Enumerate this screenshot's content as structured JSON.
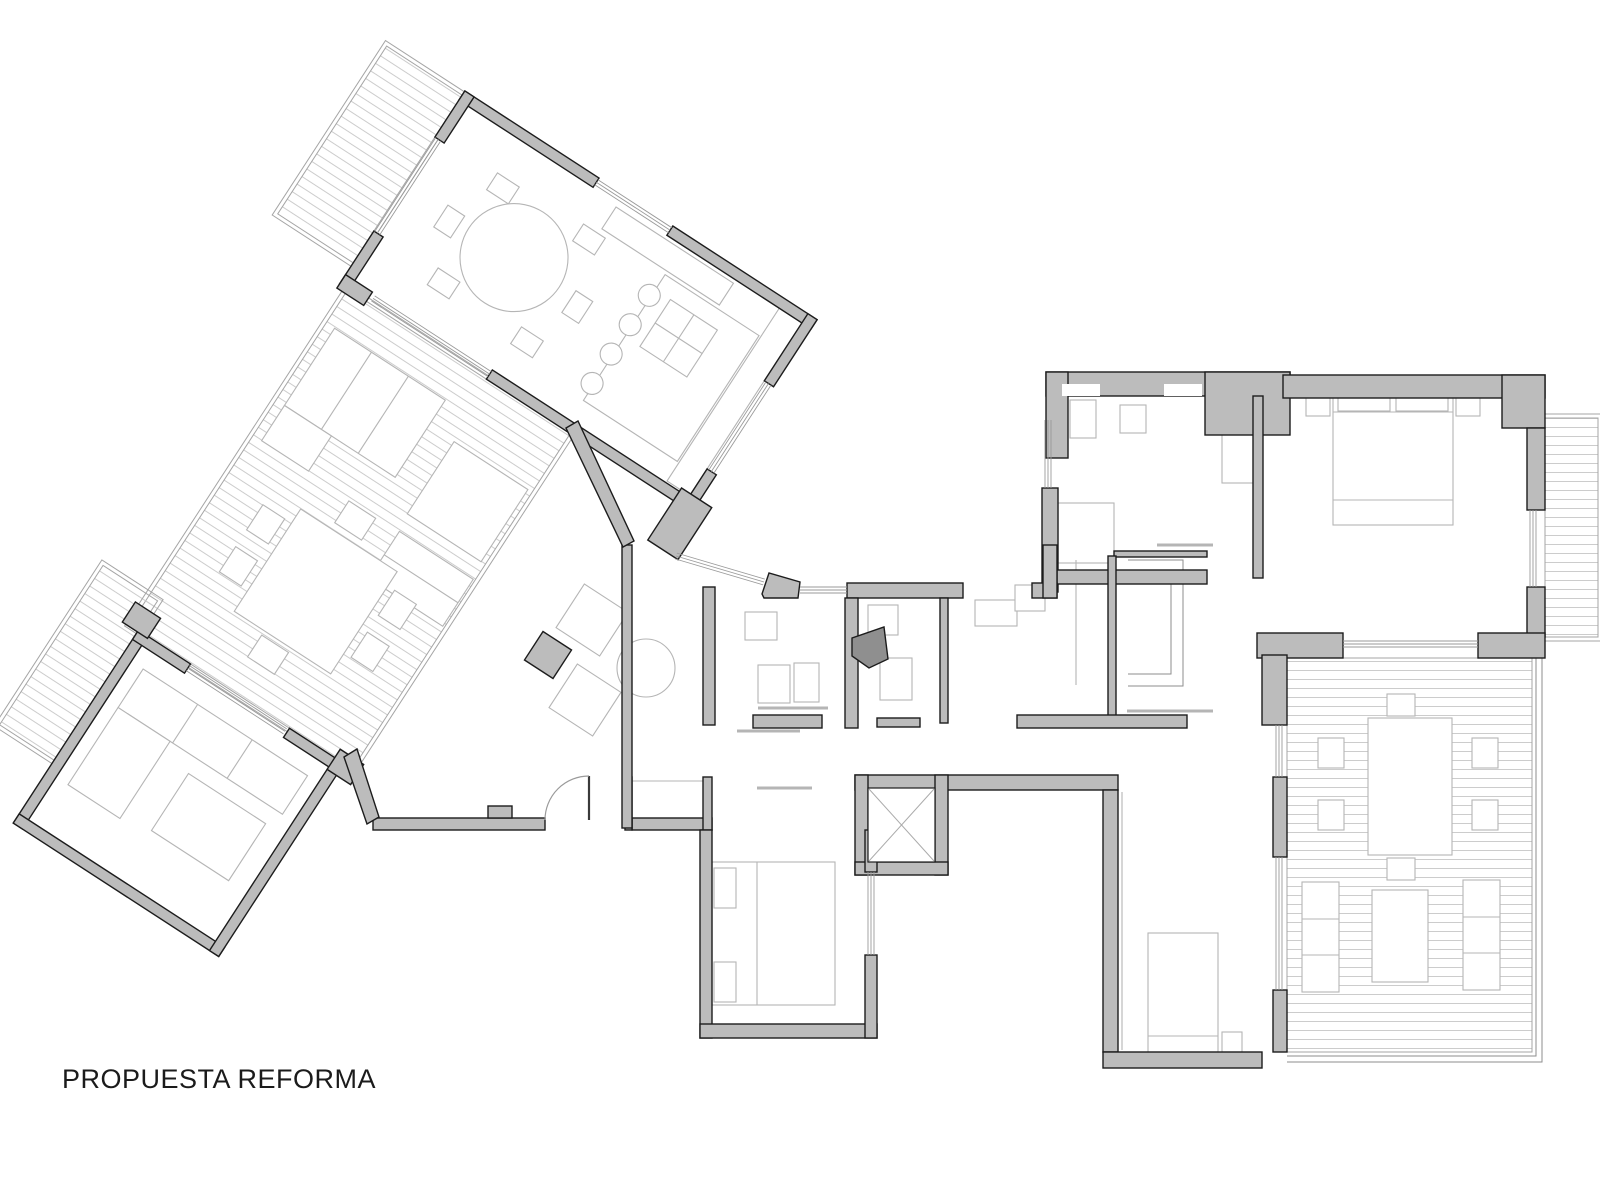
{
  "title": {
    "label": "PROPUESTA REFORMA"
  },
  "canvas": {
    "width": 1600,
    "height": 1200,
    "background": "#ffffff"
  },
  "palette": {
    "wall_fill": "#bcbcbc",
    "wall_stroke": "#1c1c1c",
    "furniture": "#b5b5b5",
    "glass": "#9a9a9a",
    "hatch": "#cccccc",
    "border": "#a5a5a5",
    "dark_poly": "#8f8f8f",
    "door": "#9a9a9a",
    "leaf": "#3a3a3a",
    "cross": "#ababab"
  },
  "left_wing_rotation": {
    "angle_deg": 33,
    "pivot_x": 700,
    "pivot_y": 500
  },
  "hatch_spacing": 9,
  "elements": {
    "hatches": [
      [
        190,
        290,
        90,
        200,
        1
      ],
      [
        290,
        515,
        265,
        400,
        1
      ],
      [
        235,
        880,
        65,
        190,
        1
      ],
      [
        1545,
        418,
        53,
        219,
        0
      ],
      [
        1287,
        658,
        245,
        394,
        0
      ]
    ],
    "borders": [
      [
        186,
        286,
        98,
        208,
        1
      ],
      [
        286,
        511,
        273,
        408,
        1
      ],
      [
        231,
        876,
        73,
        198,
        1
      ],
      [
        1545,
        414,
        57,
        227,
        0
      ]
    ],
    "walls": [
      [
        280,
        285,
        160,
        11,
        1
      ],
      [
        528,
        285,
        172,
        11,
        1
      ],
      [
        280,
        285,
        11,
        55,
        1
      ],
      [
        280,
        452,
        11,
        63,
        1
      ],
      [
        689,
        285,
        11,
        80,
        1
      ],
      [
        689,
        470,
        11,
        45,
        1
      ],
      [
        280,
        504,
        32,
        16,
        1
      ],
      [
        455,
        504,
        245,
        11,
        1
      ],
      [
        678,
        500,
        36,
        62,
        1
      ],
      [
        300,
        915,
        11,
        230,
        1
      ],
      [
        300,
        1134,
        245,
        11,
        1
      ],
      [
        534,
        915,
        11,
        230,
        1
      ],
      [
        300,
        915,
        62,
        11,
        1
      ],
      [
        480,
        915,
        65,
        11,
        1
      ],
      [
        534,
        905,
        28,
        24,
        1
      ],
      [
        282,
        893,
        30,
        24,
        1
      ],
      [
        1046,
        372,
        244,
        24,
        0
      ],
      [
        1046,
        372,
        22,
        86,
        0
      ],
      [
        1205,
        372,
        85,
        63,
        0
      ],
      [
        1283,
        375,
        262,
        23,
        0
      ],
      [
        1502,
        375,
        43,
        53,
        0
      ],
      [
        1042,
        488,
        16,
        104,
        0
      ],
      [
        1527,
        428,
        18,
        82,
        0
      ],
      [
        1527,
        587,
        18,
        50,
        0
      ],
      [
        1257,
        633,
        86,
        25,
        0
      ],
      [
        1478,
        633,
        67,
        25,
        0
      ],
      [
        1057,
        570,
        150,
        14,
        0
      ],
      [
        1114,
        551,
        93,
        6,
        0
      ],
      [
        1253,
        396,
        10,
        182,
        0
      ],
      [
        847,
        583,
        116,
        15,
        0
      ],
      [
        1032,
        583,
        25,
        15,
        0
      ],
      [
        1043,
        545,
        14,
        53,
        0
      ],
      [
        703,
        587,
        12,
        138,
        0
      ],
      [
        845,
        598,
        13,
        130,
        0
      ],
      [
        940,
        598,
        8,
        125,
        0
      ],
      [
        1108,
        556,
        8,
        164,
        0
      ],
      [
        753,
        715,
        69,
        13,
        0
      ],
      [
        877,
        718,
        43,
        9,
        0
      ],
      [
        1017,
        715,
        170,
        13,
        0
      ],
      [
        855,
        775,
        263,
        15,
        0
      ],
      [
        855,
        775,
        13,
        100,
        0
      ],
      [
        935,
        775,
        13,
        100,
        0
      ],
      [
        855,
        862,
        93,
        13,
        0
      ],
      [
        1103,
        790,
        15,
        262,
        0
      ],
      [
        1103,
        1052,
        159,
        16,
        0
      ],
      [
        373,
        818,
        172,
        12,
        0
      ],
      [
        488,
        806,
        24,
        12,
        0
      ],
      [
        632,
        818,
        80,
        12,
        0
      ],
      [
        625,
        777,
        7,
        53,
        0
      ],
      [
        703,
        777,
        9,
        53,
        0
      ],
      [
        700,
        830,
        12,
        208,
        0
      ],
      [
        700,
        1024,
        177,
        14,
        0
      ],
      [
        865,
        955,
        12,
        83,
        0
      ],
      [
        865,
        830,
        12,
        42,
        0
      ],
      [
        1262,
        655,
        25,
        70,
        0
      ],
      [
        1273,
        777,
        14,
        80,
        0
      ],
      [
        1273,
        990,
        14,
        62,
        0
      ],
      [
        622,
        545,
        10,
        283,
        0
      ]
    ],
    "whites": [
      [
        1062,
        384,
        38,
        12,
        0
      ],
      [
        1164,
        384,
        38,
        12,
        0
      ],
      [
        868,
        788,
        67,
        74,
        1
      ]
    ],
    "polys": [
      {
        "p": [
          [
            566,
            428
          ],
          [
            578,
            421
          ],
          [
            634,
            541
          ],
          [
            623,
            547
          ]
        ],
        "f": ""
      },
      {
        "p": [
          [
            762,
            594
          ],
          [
            769,
            573
          ],
          [
            800,
            582
          ],
          [
            798,
            598
          ],
          [
            764,
            598
          ]
        ],
        "f": ""
      },
      {
        "p": [
          [
            852,
            638
          ],
          [
            884,
            627
          ],
          [
            888,
            659
          ],
          [
            869,
            668
          ],
          [
            852,
            656
          ]
        ],
        "f": "#8f8f8f"
      },
      {
        "p": [
          [
            344,
            757
          ],
          [
            357,
            749
          ],
          [
            379,
            817
          ],
          [
            367,
            824
          ]
        ],
        "f": ""
      }
    ],
    "glass": [
      [
        440,
        290,
        528,
        290,
        1
      ],
      [
        284,
        340,
        284,
        452,
        1
      ],
      [
        694,
        365,
        694,
        470,
        1
      ],
      [
        316,
        509,
        455,
        509,
        1
      ],
      [
        362,
        920,
        478,
        920,
        1
      ],
      [
        800,
        590,
        847,
        590,
        0
      ],
      [
        871,
        872,
        871,
        955,
        0
      ],
      [
        1533,
        510,
        1533,
        587,
        0
      ],
      [
        1343,
        644,
        1478,
        644,
        0
      ],
      [
        1048,
        420,
        1048,
        488,
        0
      ],
      [
        1279,
        725,
        1279,
        777,
        0
      ],
      [
        1279,
        857,
        1279,
        990,
        0
      ],
      [
        676,
        556,
        764,
        582,
        0
      ]
    ],
    "frects": [
      [
        470,
        300,
        140,
        26,
        1
      ],
      [
        548,
        330,
        112,
        150,
        1
      ],
      [
        566,
        348,
        56,
        56,
        1
      ],
      [
        662,
        296,
        27,
        206,
        1
      ],
      [
        300,
        555,
        132,
        92,
        1
      ],
      [
        300,
        647,
        56,
        42,
        1
      ],
      [
        462,
        585,
        88,
        86,
        1
      ],
      [
        465,
        690,
        88,
        56,
        1
      ],
      [
        370,
        725,
        115,
        122,
        1
      ],
      [
        336,
        742,
        26,
        30,
        1
      ],
      [
        336,
        792,
        26,
        30,
        1
      ],
      [
        493,
        742,
        26,
        30,
        1
      ],
      [
        493,
        792,
        26,
        30,
        1
      ],
      [
        406,
        692,
        32,
        26,
        1
      ],
      [
        406,
        852,
        32,
        26,
        1
      ],
      [
        325,
        945,
        196,
        46,
        1
      ],
      [
        325,
        991,
        62,
        92,
        1
      ],
      [
        420,
        1008,
        92,
        68,
        1
      ],
      [
        352,
        336,
        26,
        20,
        1
      ],
      [
        452,
        332,
        26,
        20,
        1
      ],
      [
        328,
        390,
        20,
        26,
        1
      ],
      [
        482,
        392,
        20,
        26,
        1
      ],
      [
        354,
        448,
        26,
        20,
        1
      ],
      [
        456,
        452,
        26,
        20,
        1
      ],
      [
        1070,
        400,
        26,
        38,
        0
      ],
      [
        1120,
        405,
        26,
        28,
        0
      ],
      [
        1222,
        403,
        33,
        80,
        0
      ],
      [
        1058,
        503,
        56,
        60,
        0
      ],
      [
        1333,
        390,
        120,
        135,
        0
      ],
      [
        1338,
        393,
        52,
        18,
        0
      ],
      [
        1396,
        393,
        52,
        18,
        0
      ],
      [
        1306,
        392,
        24,
        24,
        0
      ],
      [
        1456,
        392,
        24,
        24,
        0
      ],
      [
        1148,
        933,
        70,
        119,
        0
      ],
      [
        1222,
        1032,
        20,
        20,
        0
      ],
      [
        712,
        862,
        123,
        143,
        0
      ],
      [
        714,
        868,
        22,
        40,
        0
      ],
      [
        714,
        962,
        22,
        40,
        0
      ],
      [
        1368,
        718,
        84,
        137,
        0
      ],
      [
        1318,
        738,
        26,
        30,
        0
      ],
      [
        1318,
        800,
        26,
        30,
        0
      ],
      [
        1472,
        738,
        26,
        30,
        0
      ],
      [
        1472,
        800,
        26,
        30,
        0
      ],
      [
        1387,
        694,
        28,
        22,
        0
      ],
      [
        1387,
        858,
        28,
        22,
        0
      ],
      [
        1302,
        882,
        37,
        110,
        0
      ],
      [
        1463,
        880,
        37,
        110,
        0
      ],
      [
        1372,
        890,
        56,
        92,
        0
      ],
      [
        745,
        612,
        32,
        28,
        0
      ],
      [
        758,
        665,
        32,
        38,
        0
      ],
      [
        794,
        663,
        25,
        39,
        0
      ],
      [
        868,
        605,
        30,
        30,
        0
      ],
      [
        880,
        658,
        32,
        42,
        0
      ],
      [
        975,
        600,
        42,
        26,
        0
      ],
      [
        1015,
        585,
        30,
        26,
        0
      ]
    ],
    "drects": [
      [
        592,
        620,
        52,
        33,
        0
      ],
      [
        585,
        700,
        52,
        33,
        0
      ],
      [
        548,
        655,
        34,
        33,
        1
      ]
    ],
    "circles": [
      [
        412,
        398,
        54,
        1
      ],
      [
        546,
        356,
        11,
        1
      ],
      [
        546,
        391,
        11,
        1
      ],
      [
        546,
        426,
        11,
        1
      ],
      [
        546,
        461,
        11,
        1
      ],
      [
        646,
        668,
        29,
        0
      ]
    ],
    "lines": [
      [
        594,
        348,
        594,
        404,
        1,
        1.1,
        ""
      ],
      [
        566,
        376,
        622,
        376,
        1,
        1.1,
        ""
      ],
      [
        757,
        862,
        757,
        1005,
        0,
        1.1,
        ""
      ],
      [
        1333,
        500,
        1453,
        500,
        0,
        1.1,
        ""
      ],
      [
        1148,
        1036,
        1218,
        1036,
        0,
        1.1,
        ""
      ],
      [
        1157,
        545,
        1213,
        545,
        0,
        3,
        ""
      ],
      [
        758,
        708,
        828,
        708,
        0,
        3,
        ""
      ],
      [
        1127,
        711,
        1213,
        711,
        0,
        3,
        ""
      ],
      [
        737,
        731,
        800,
        731,
        0,
        3,
        ""
      ],
      [
        757,
        788,
        812,
        788,
        0,
        3,
        ""
      ],
      [
        632,
        781,
        703,
        781,
        0,
        1.1,
        ""
      ],
      [
        1122,
        792,
        1122,
        1050,
        0,
        1.1,
        ""
      ],
      [
        1076,
        560,
        1076,
        685,
        0,
        1.1,
        ""
      ],
      [
        344,
        555,
        344,
        647,
        1,
        1.1,
        ""
      ],
      [
        388,
        555,
        388,
        647,
        1,
        1.1,
        ""
      ],
      [
        465,
        718,
        553,
        718,
        1,
        1.1,
        ""
      ],
      [
        390,
        945,
        390,
        991,
        1,
        1.1,
        ""
      ],
      [
        455,
        945,
        455,
        991,
        1,
        1.1,
        ""
      ],
      [
        1302,
        919,
        1339,
        919,
        0,
        1.1,
        ""
      ],
      [
        1302,
        955,
        1339,
        955,
        0,
        1.1,
        ""
      ],
      [
        1463,
        917,
        1500,
        917,
        0,
        1.1,
        ""
      ],
      [
        1463,
        953,
        1500,
        953,
        0,
        1.1,
        ""
      ],
      [
        1333,
        412,
        1453,
        412,
        0,
        1.1,
        ""
      ],
      [
        589,
        776,
        589,
        820,
        0,
        2.2,
        "#3a3a3a"
      ]
    ],
    "plines": [
      [
        [
          1128,
          560
        ],
        [
          1183,
          560
        ],
        [
          1183,
          686
        ],
        [
          1128,
          686
        ]
      ],
      [
        [
          1128,
          572
        ],
        [
          1171,
          572
        ],
        [
          1171,
          674
        ],
        [
          1128,
          674
        ]
      ],
      [
        [
          1287,
          1062
        ],
        [
          1542,
          1062
        ],
        [
          1542,
          658
        ]
      ],
      [
        [
          1287,
          1056
        ],
        [
          1536,
          1056
        ],
        [
          1536,
          658
        ]
      ]
    ],
    "arcs": [
      "M 545 820 A 44 44 0 0 1 589 776"
    ],
    "crosses": [
      [
        869,
        789,
        934,
        861,
        0
      ],
      [
        934,
        789,
        869,
        861,
        0
      ]
    ]
  }
}
